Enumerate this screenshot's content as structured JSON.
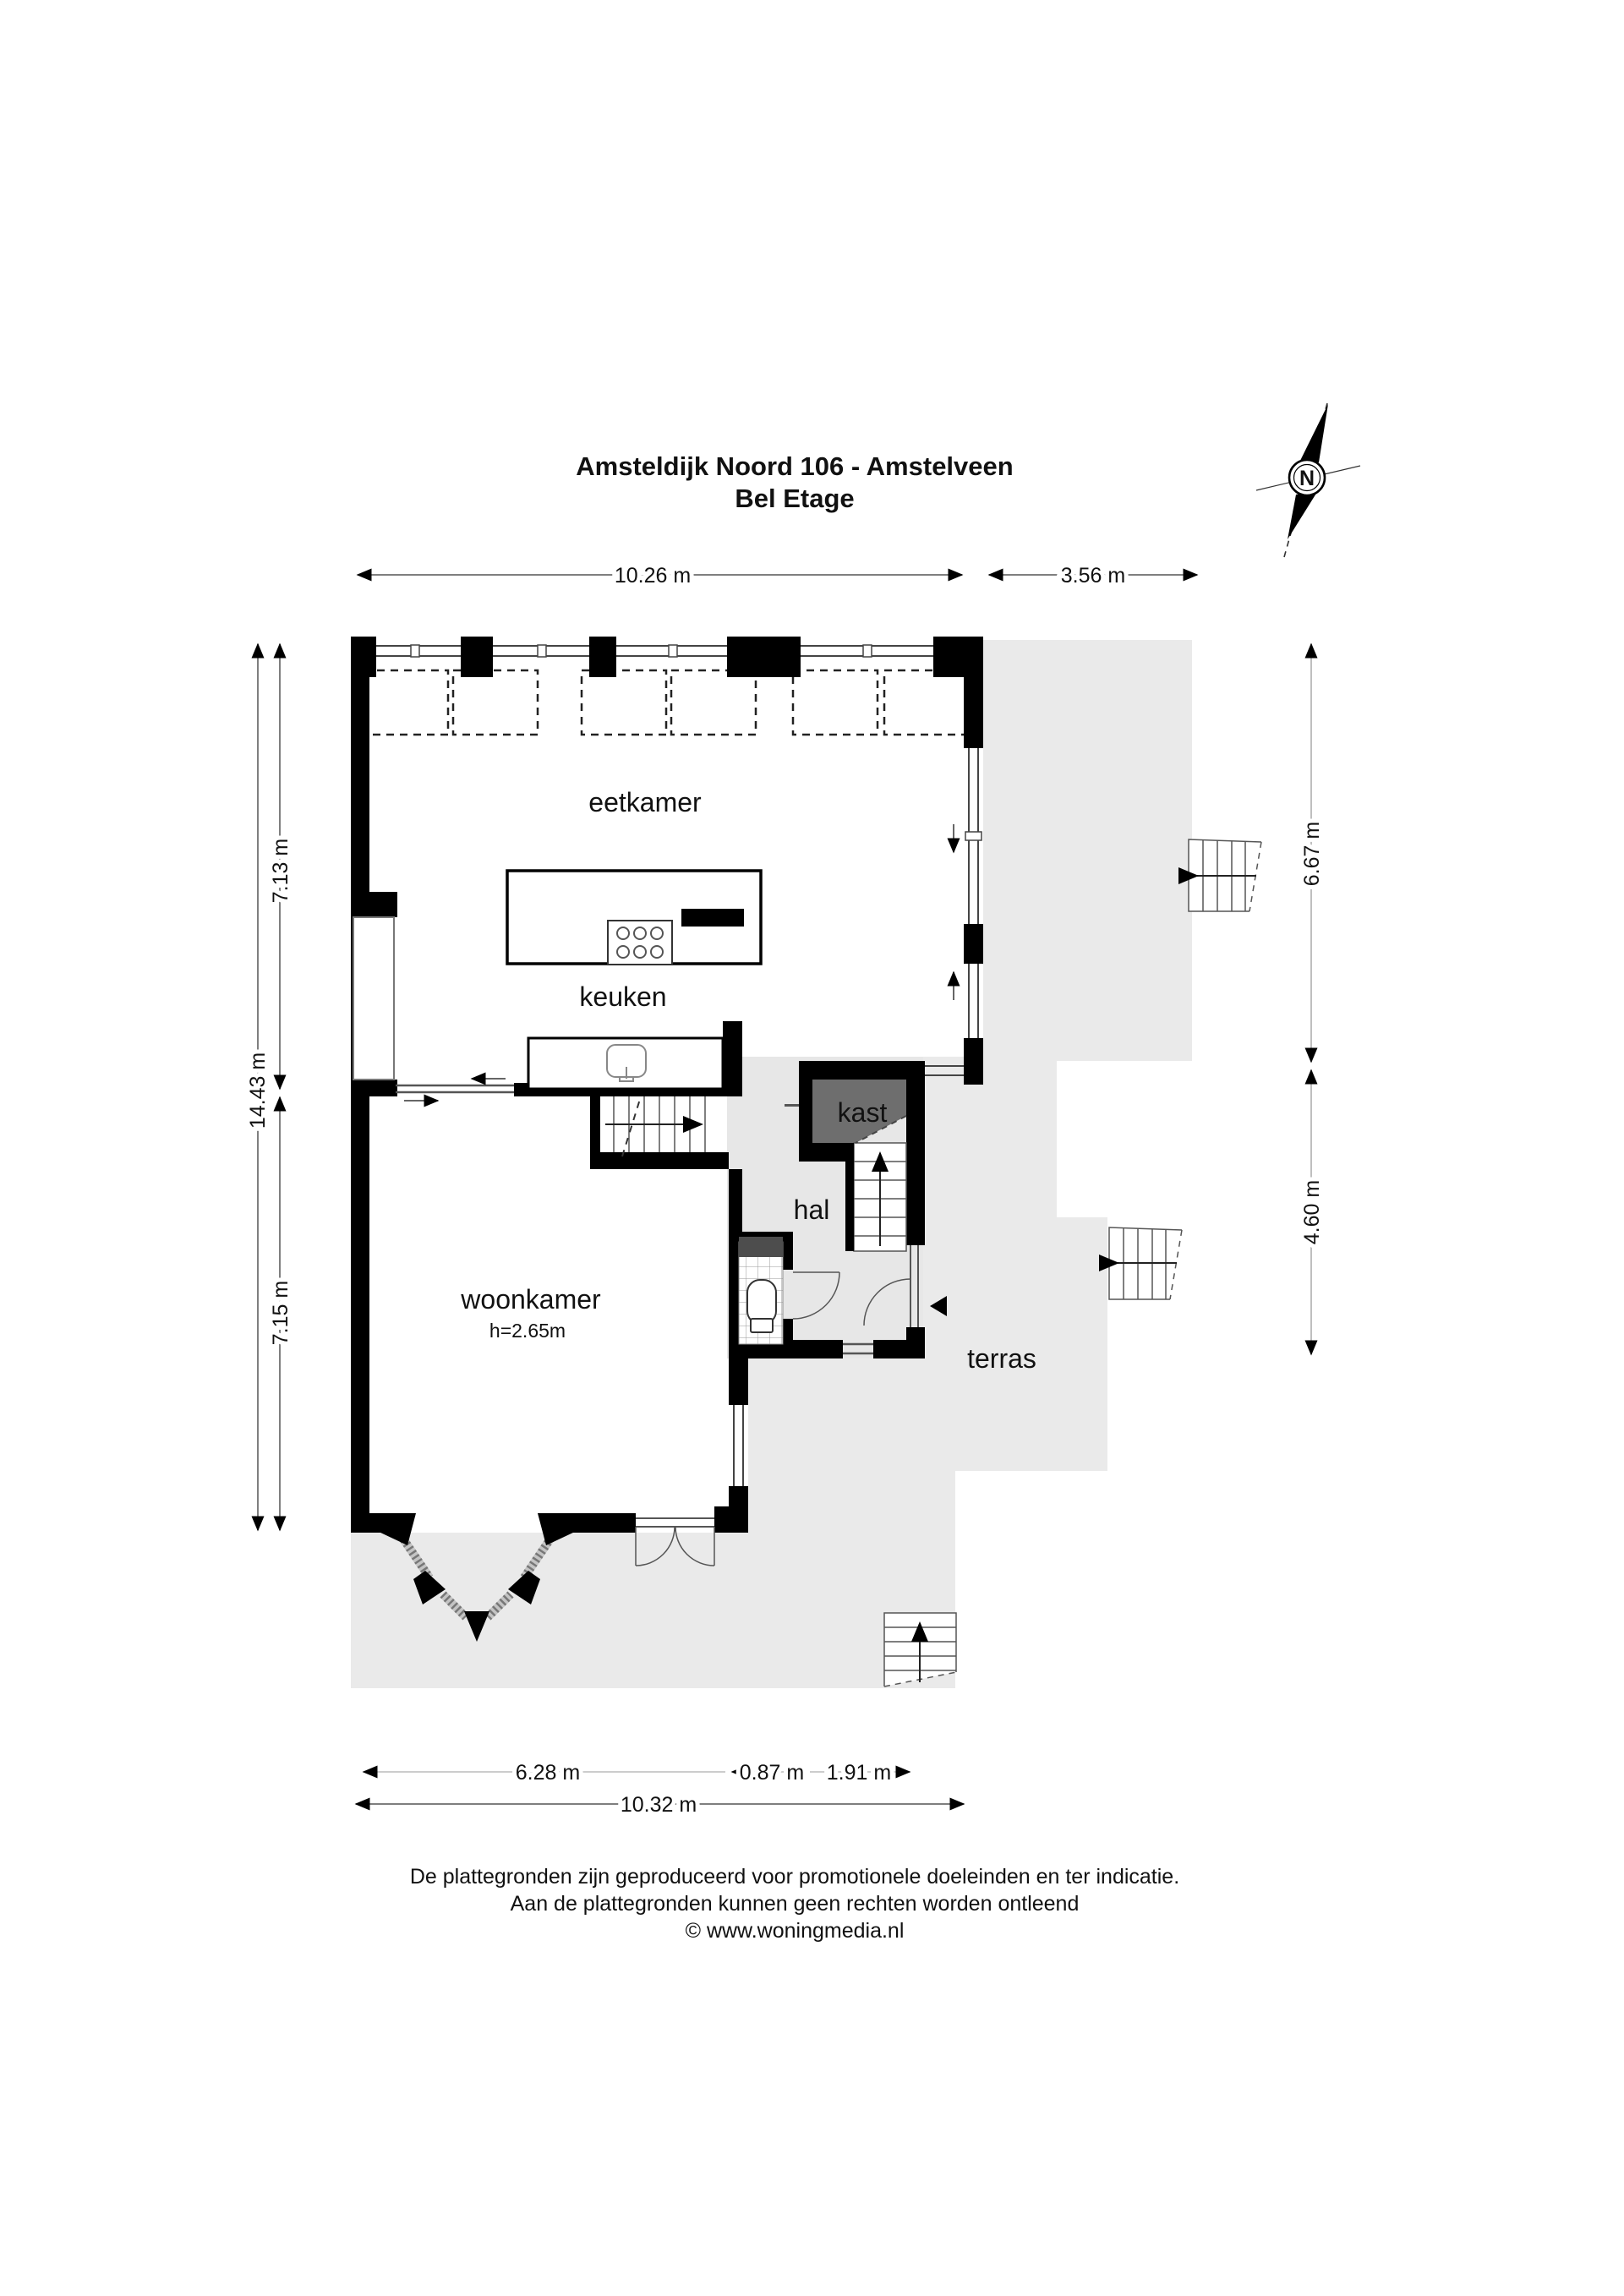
{
  "title": {
    "line1": "Amsteldijk Noord 106 - Amstelveen",
    "line2": "Bel Etage"
  },
  "compass": {
    "label": "N"
  },
  "rooms": {
    "eetkamer": "eetkamer",
    "keuken": "keuken",
    "kast": "kast",
    "hal": "hal",
    "woonkamer": "woonkamer",
    "woonkamer_height": "h=2.65m",
    "terras": "terras"
  },
  "dimensions": {
    "top_main": "10.26 m",
    "top_right": "3.56 m",
    "left_upper": "7.13 m",
    "left_total": "14.43 m",
    "left_lower": "7.15 m",
    "right_upper": "6.67 m",
    "right_lower": "4.60 m",
    "bottom_left": "6.28 m",
    "bottom_mid": "0.87 m",
    "bottom_right": "1.91 m",
    "bottom_total": "10.32 m"
  },
  "footer": {
    "line1": "De plattegronden zijn geproduceerd voor promotionele doeleinden en ter indicatie.",
    "line2": "Aan de plattegronden kunnen geen rechten worden ontleend",
    "line3": "© www.woningmedia.nl"
  },
  "colors": {
    "wall": "#000000",
    "terrace_floor": "#eaeaea",
    "hall_floor": "#e7e7e7",
    "closet_fill": "#6e6e6e",
    "wc_shelf": "#4d4d4d",
    "glazing": "#c4c4c4",
    "dimension_line": "#444444"
  }
}
